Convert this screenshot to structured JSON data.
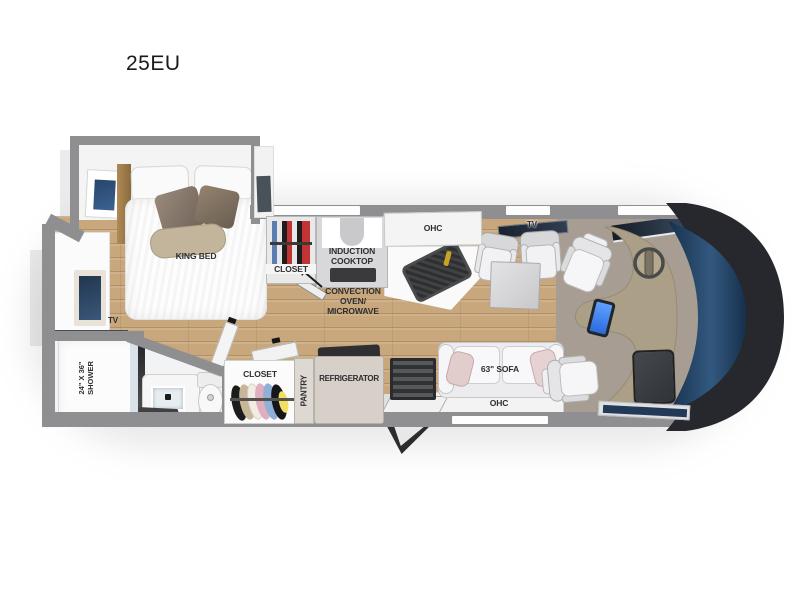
{
  "title": "25EU",
  "bedroom": {
    "bed": "KING BED",
    "tv": "TV"
  },
  "kitchen": {
    "closet": "CLOSET",
    "cooktop": "INDUCTION COOKTOP",
    "ohc": "OHC",
    "convection": "CONVECTION OVEN/ MICROWAVE"
  },
  "bathroom": {
    "shower_size": "24\" X 36\"",
    "shower": "SHOWER"
  },
  "hall": {
    "closet": "CLOSET",
    "pantry": "PANTRY",
    "refrigerator": "REFRIGERATOR"
  },
  "living": {
    "tv": "TV",
    "sofa": "63\" SOFA",
    "ohc": "OHC"
  },
  "colors": {
    "wood": "#c9a87c",
    "carpet": "#a79d92",
    "wall": "#8f8f91",
    "windshield": "#1d3a57",
    "windshield_frame": "#26282d",
    "dashboard": "#ab9f88",
    "window_blue": "#2e5d9e",
    "screen_blue": "#3b82f6",
    "label": "#2e2e30"
  }
}
